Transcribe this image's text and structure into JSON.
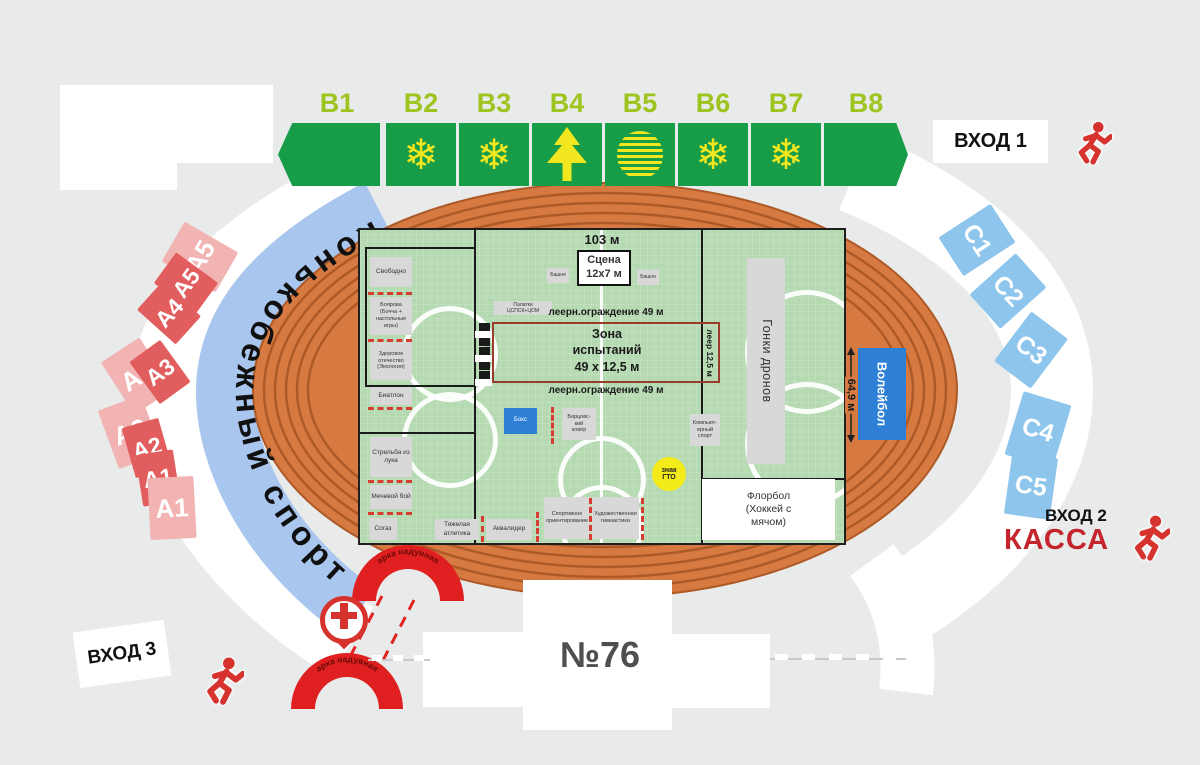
{
  "ring_text": "Конькобежный спорт",
  "arch_label": "арка надувная",
  "building_number": "№76",
  "entrances": {
    "e1": "ВХОД 1",
    "e2": "ВХОД 2",
    "e3": "ВХОД 3",
    "kassa": "КАССА"
  },
  "sectors": {
    "b": [
      "B1",
      "B2",
      "B3",
      "B4",
      "B5",
      "B6",
      "B7",
      "B8"
    ],
    "b_icons": [
      "none",
      "snowflake",
      "snowflake",
      "tree",
      "globe",
      "snowflake",
      "snowflake",
      "none"
    ],
    "a": [
      "A5",
      "A5",
      "A4",
      "A3",
      "A3",
      "A2",
      "A2",
      "A1",
      "A1"
    ],
    "c": [
      "C1",
      "C2",
      "C3",
      "C4",
      "C5"
    ]
  },
  "field": {
    "free": "Свободно",
    "boyarova": "Боярова\n(Бочча +\nнастольные\nигры)",
    "zdorovoe": "Здоровое\nотечество\n(Экология)",
    "biathlon": "Биатлон",
    "archery": "Стрельба из\nлука",
    "sword": "Мечевой бой",
    "sogaz": "Согаз",
    "weightlifting": "Тяжелая\nатлетика",
    "aqualider": "Аквалидер",
    "orienteering": "Спортивное\nориентирование",
    "gymnastics": "Художественная\nгимнастика",
    "boxing": "Бокс",
    "wrestling": "Борцовс-\nкий\nковёр",
    "esports": "Компьют-\nерный\nспорт",
    "gto": "знак\nГТО",
    "floorball": "Флорбол\n(Хоккей с\nмячом)",
    "drones": "Гонки дронов",
    "volleyball": "Волейбол",
    "stage": "Сцена\n12х7 м",
    "tower": "Башня",
    "tents": "Палатки\nЦСПСК+ЦОМ",
    "rail_fence_top": "леерн.ограждение 49 м",
    "rail_fence_bottom": "леерн.ограждение 49 м",
    "rail_side": "леер 12,5 м",
    "test_zone": "Зона\nиспытаний\n49 х 12,5 м",
    "construction": "Конструкция 3х0,8 м",
    "m103": "103 м",
    "m649": "64,9 м"
  },
  "colors": {
    "track": "#d67a41",
    "track_ring": "#ad5a28",
    "field_green": "#b5d9b0",
    "sector_green": "#179c48",
    "sector_label_green": "#9ec41f",
    "pattern_yellow": "#f2e71e",
    "sector_blue": "#8ec5ec",
    "sector_pink_light": "#f2b3b3",
    "sector_red": "#e25d5d",
    "band_blue": "#a9c6ee",
    "accent_red": "#d6332e",
    "kassa_red": "#c4242b",
    "gto_yellow": "#f4ec1a",
    "zone_border": "#9a3c2c",
    "cyan": "#3ad2e4",
    "blue_box": "#2e7fd6"
  }
}
